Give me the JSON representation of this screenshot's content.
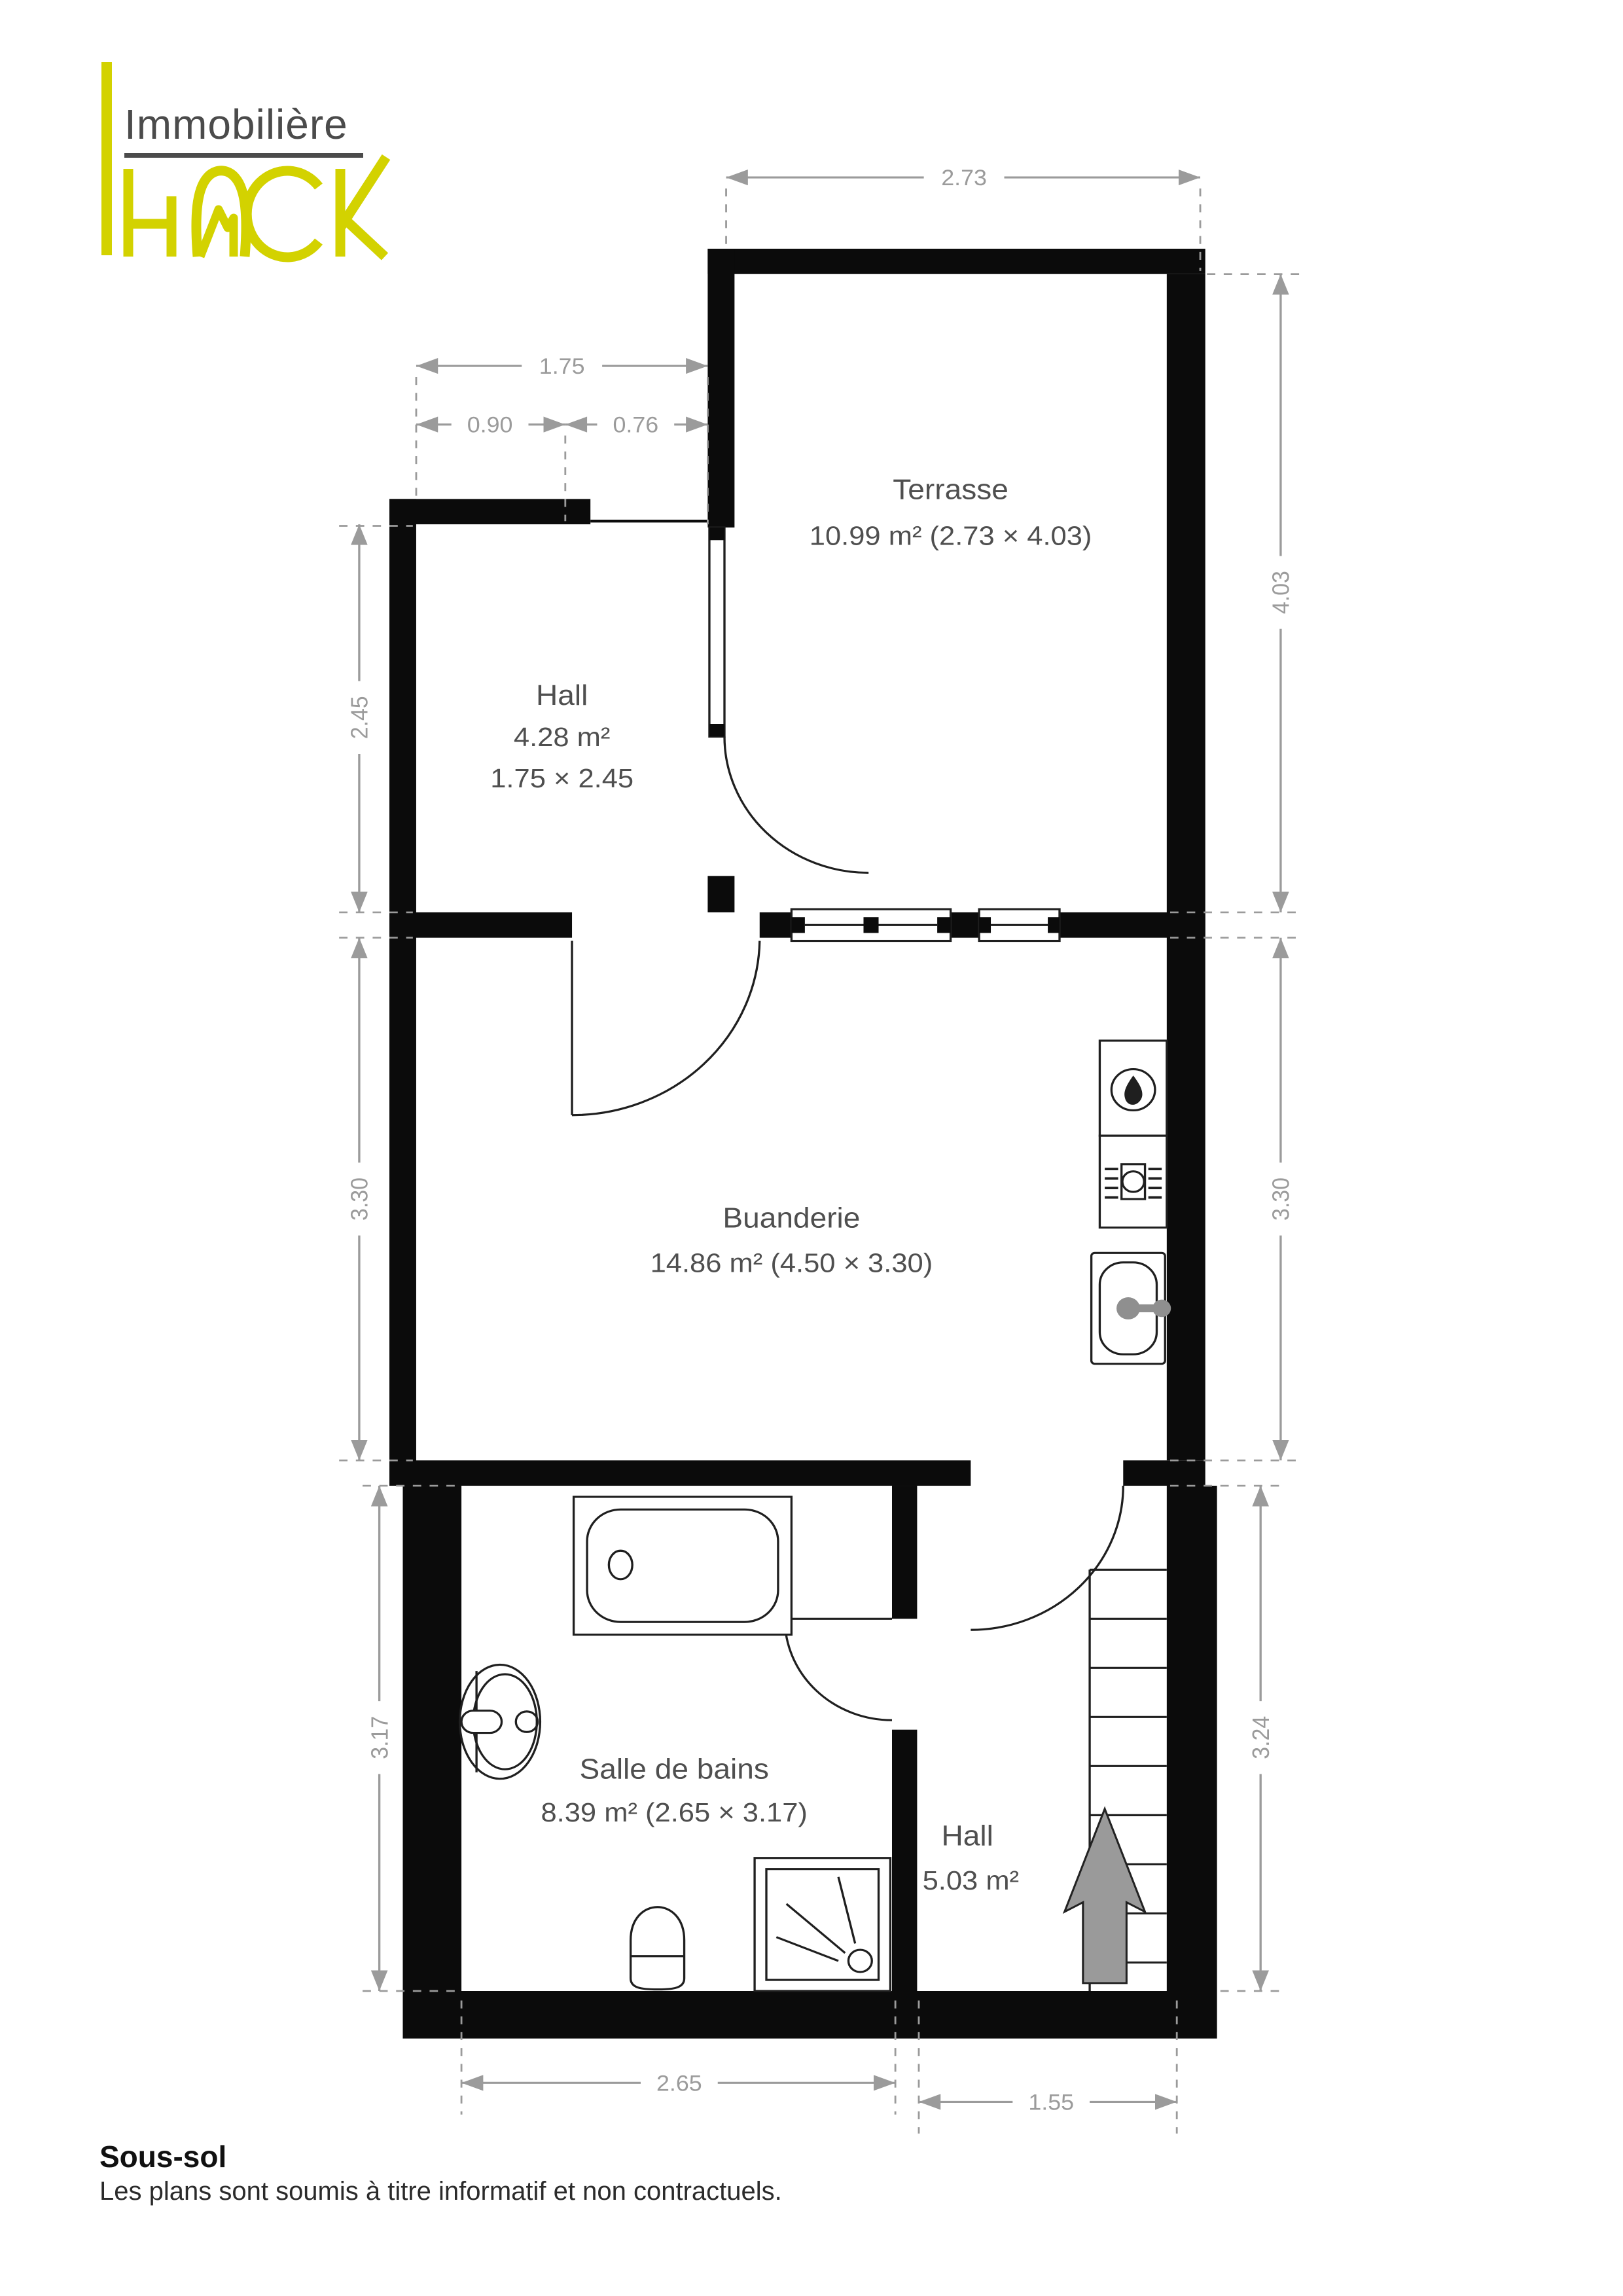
{
  "logo": {
    "line1": "Immobilière",
    "brand_h": "H",
    "brand_c": "C",
    "brand_k": "K"
  },
  "rooms": [
    {
      "name": "Terrasse",
      "line2": "10.99 m² (2.73 × 4.03)",
      "line3": ""
    },
    {
      "name": "Hall",
      "line2": "4.28 m²",
      "line3": "1.75 × 2.45"
    },
    {
      "name": "Buanderie",
      "line2": "14.86 m² (4.50 × 3.30)",
      "line3": ""
    },
    {
      "name": "Salle de bains",
      "line2": "8.39 m² (2.65 × 3.17)",
      "line3": ""
    },
    {
      "name": "Hall",
      "line2": "5.03 m²",
      "line3": ""
    }
  ],
  "dimensions": {
    "terrace_width": "2.73",
    "hall_top_total": "1.75",
    "hall_top_left": "0.90",
    "hall_top_right": "0.76",
    "hall_left_height": "2.45",
    "terrace_right_height": "4.03",
    "buanderie_left_height": "3.30",
    "buanderie_right_height": "3.30",
    "bathroom_left_height": "3.17",
    "hall_lower_right_height": "3.24",
    "bathroom_bottom_width": "2.65",
    "hall_lower_bottom_width": "1.55"
  },
  "footer": {
    "title": "Sous-sol",
    "disclaimer": "Les plans sont soumis à titre informatif et non contractuels."
  },
  "colors": {
    "wall": "#0b0b0b",
    "dimension": "#9b9b9b",
    "label": "#4f4f4f",
    "brand_yellow": "#d3d200",
    "arrow_gray": "#9a9a9a"
  },
  "fixtures": [
    "boiler-flame-icon",
    "washing-machine-icon",
    "laundry-sink",
    "bathtub",
    "washbasin",
    "toilet",
    "shower",
    "stairs",
    "up-arrow"
  ]
}
